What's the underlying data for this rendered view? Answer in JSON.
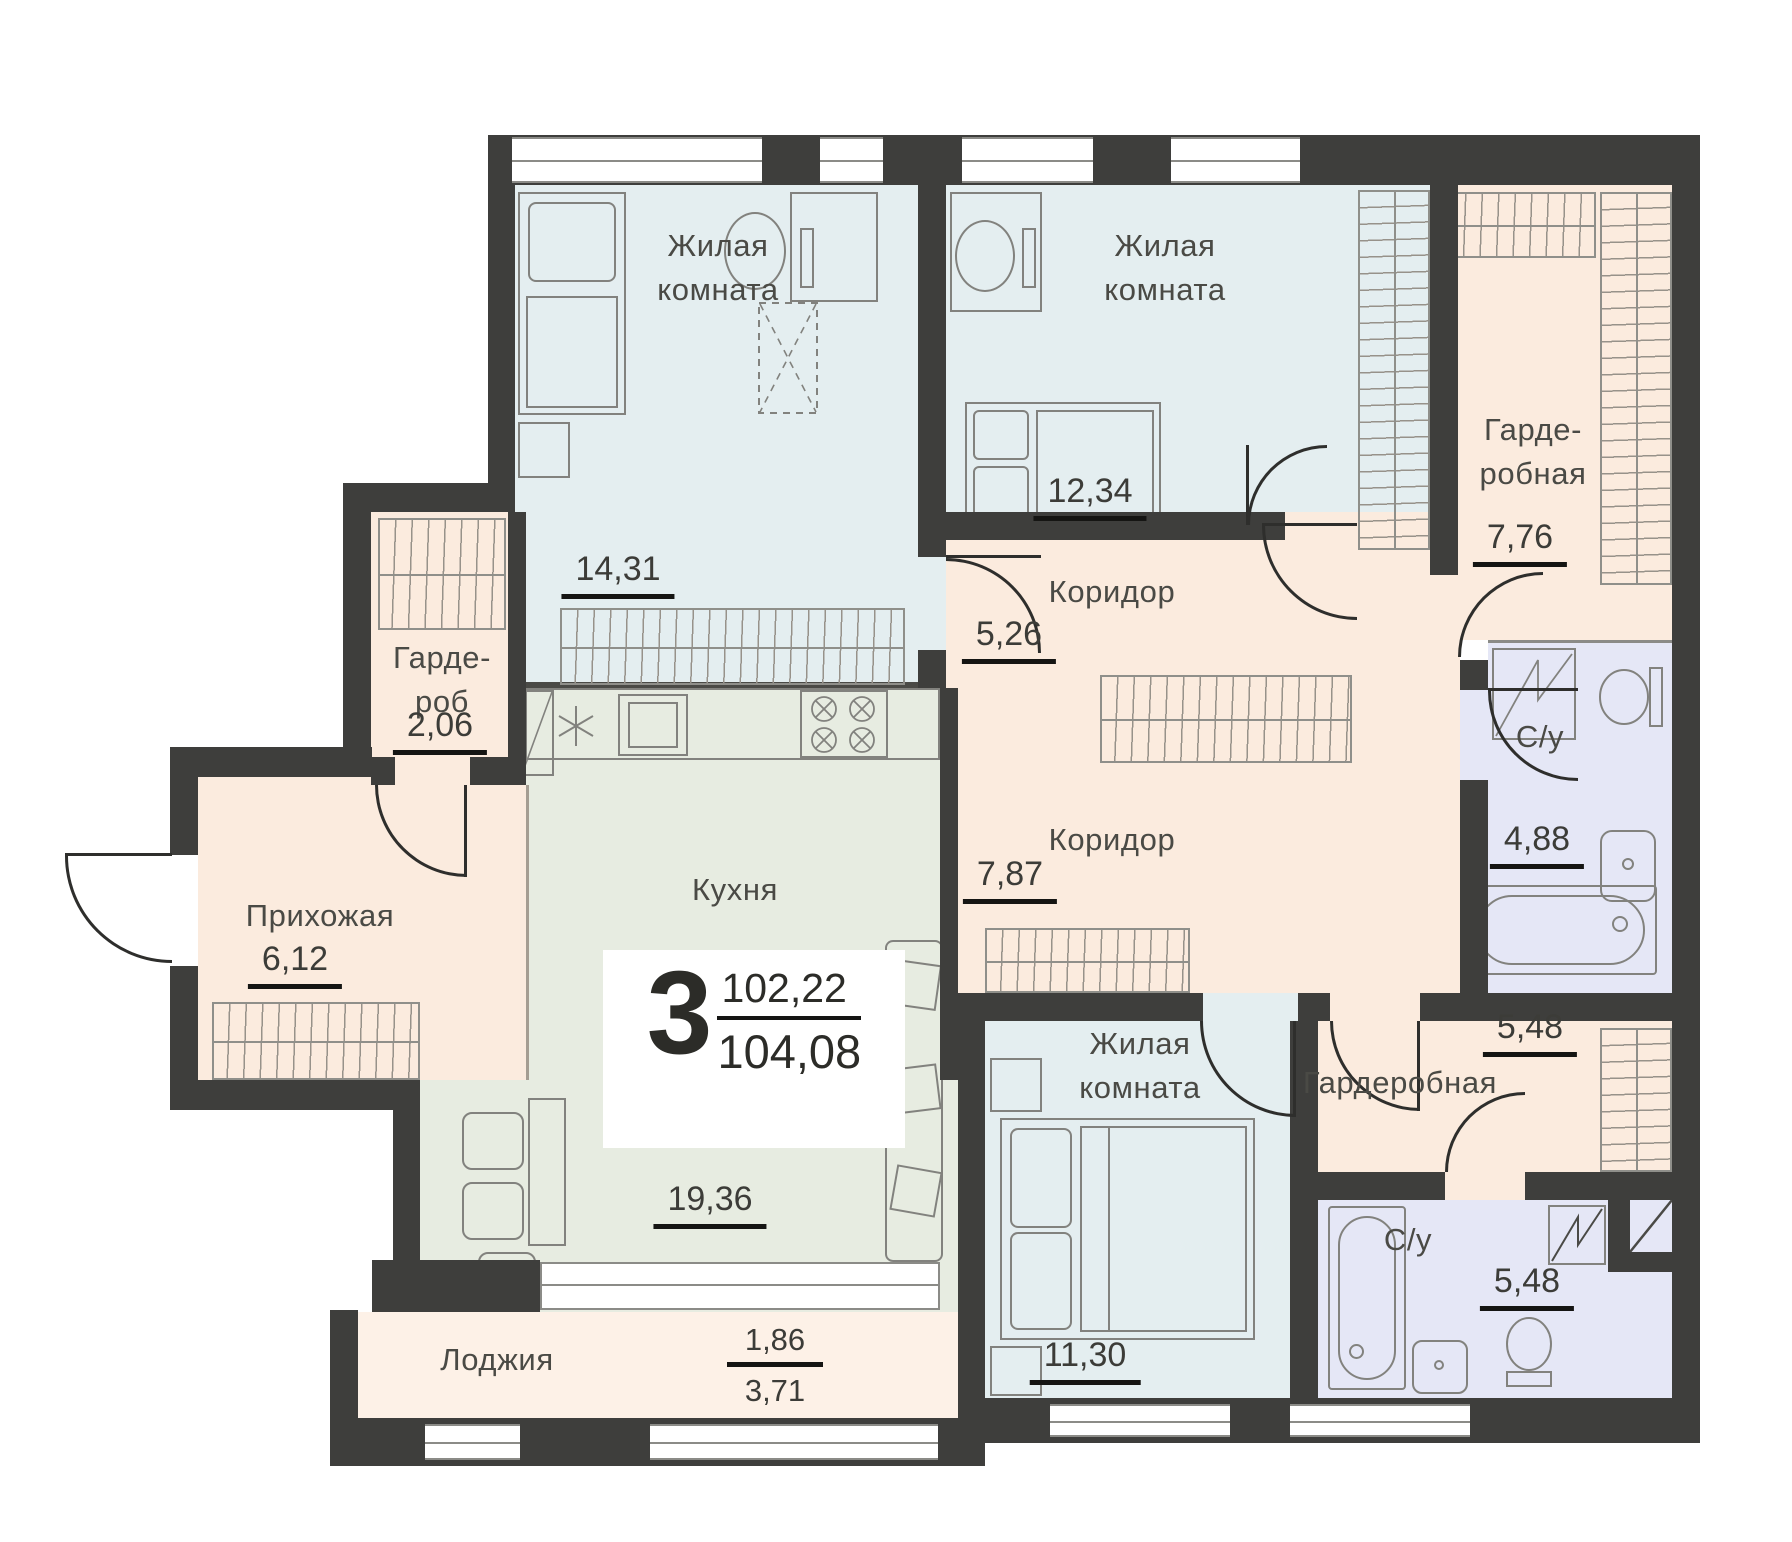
{
  "plan": {
    "summary": {
      "rooms_count": "3",
      "area_living": "102,22",
      "area_total": "104,08"
    },
    "rooms": [
      {
        "id": "living-room-1",
        "line1": "Жилая",
        "line2": "комната",
        "area": "14,31"
      },
      {
        "id": "living-room-2",
        "line1": "Жилая",
        "line2": "комната",
        "area": "12,34"
      },
      {
        "id": "wardrobe-top",
        "line1": "Гарде-",
        "line2": "робная",
        "area": "7,76"
      },
      {
        "id": "corridor-1",
        "line1": "Коридор",
        "line2": "",
        "area": "5,26"
      },
      {
        "id": "wardrobe-small",
        "line1": "Гарде-",
        "line2": "роб",
        "area": "2,06"
      },
      {
        "id": "hallway",
        "line1": "Прихожая",
        "line2": "",
        "area": "6,12"
      },
      {
        "id": "kitchen",
        "line1": "Кухня",
        "line2": "",
        "area": "19,36"
      },
      {
        "id": "corridor-2",
        "line1": "Коридор",
        "line2": "",
        "area": "7,87"
      },
      {
        "id": "bathroom-1",
        "line1": "С/у",
        "line2": "",
        "area": "4,88"
      },
      {
        "id": "wardrobe-right",
        "line1": "Гардеробная",
        "line2": "",
        "area": "5,48"
      },
      {
        "id": "living-room-3",
        "line1": "Жилая",
        "line2": "комната",
        "area": "11,30"
      },
      {
        "id": "bathroom-2",
        "line1": "С/у",
        "line2": "",
        "area": "5,48"
      },
      {
        "id": "loggia",
        "line1": "Лоджия",
        "area_partial": "1,86",
        "area_total": "3,71"
      }
    ],
    "colors": {
      "wall": "#3e3e3c",
      "living_room_fill": "#e4eef0",
      "kitchen_fill": "#e7ece1",
      "utility_fill": "#fbebde",
      "bathroom_fill": "#e5e7f6",
      "loggia_fill": "#fdf1e7",
      "area_underline": "#151513"
    }
  }
}
